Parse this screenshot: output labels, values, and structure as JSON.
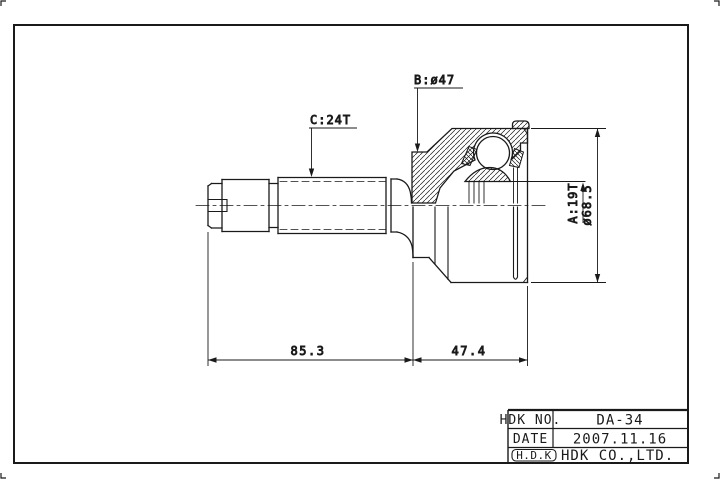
{
  "sheet": {
    "type": "engineering-drawing",
    "part": "constant-velocity-joint",
    "background_color": "#ffffff",
    "line_color": "#1a1a1a"
  },
  "labels": {
    "spline_c": "C:24T",
    "diameter_b": "B:ø47",
    "spline_a": "A:19T",
    "outer_diameter": "ø68.5",
    "shaft_length": "85.3",
    "joint_length": "47.4"
  },
  "title_block": {
    "rows": [
      {
        "label": "HDK NO.",
        "value": "DA-34"
      },
      {
        "label": "DATE",
        "value": "2007.11.16"
      },
      {
        "label": "H.D.K",
        "value": "HDK CO.,LTD."
      }
    ]
  }
}
